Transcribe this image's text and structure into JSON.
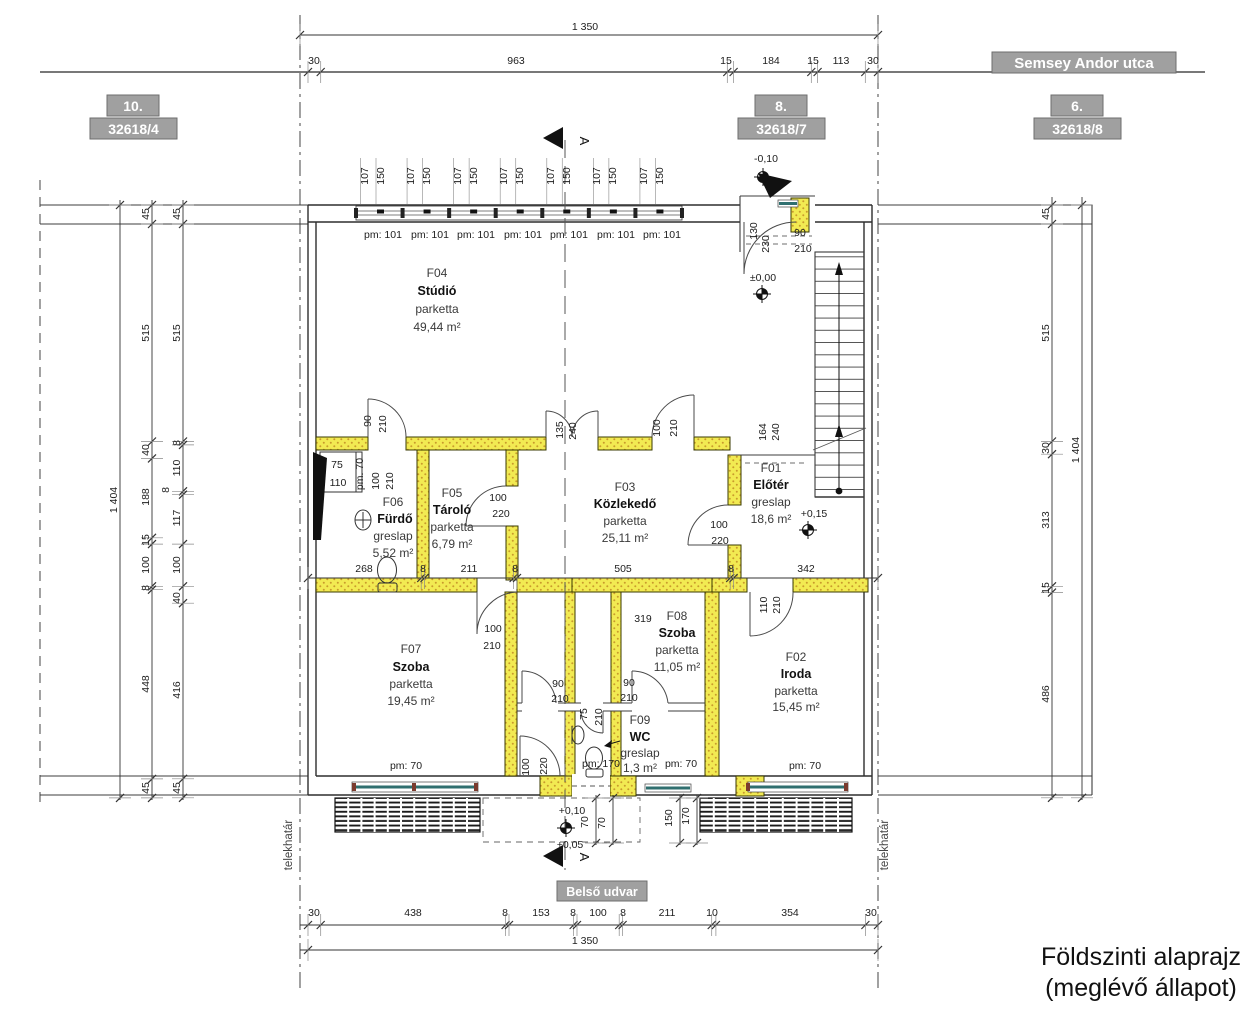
{
  "drawing_title": {
    "line1": "Földszinti alaprajz",
    "line2": "(meglévő állapot)"
  },
  "street": {
    "name": "Semsey Andor utca"
  },
  "courtyard": {
    "name": "Belső udvar"
  },
  "boundary": {
    "label_left": "telekhatár",
    "label_right": "telekhatár"
  },
  "section": {
    "letter": "A"
  },
  "parcels": [
    {
      "number": "10.",
      "lot": "32618/4"
    },
    {
      "number": "8.",
      "lot": "32618/7"
    },
    {
      "number": "6.",
      "lot": "32618/8"
    }
  ],
  "rooms": [
    {
      "id": "F04",
      "name": "Stúdió",
      "finish": "parketta",
      "area": "49,44 m²"
    },
    {
      "id": "F05",
      "name": "Tároló",
      "finish": "parketta",
      "area": "6,79 m²"
    },
    {
      "id": "F06",
      "name": "Fürdő",
      "finish": "greslap",
      "area": "5,52 m²"
    },
    {
      "id": "F03",
      "name": "Közlekedő",
      "finish": "parketta",
      "area": "25,11 m²"
    },
    {
      "id": "F01",
      "name": "Előtér",
      "finish": "greslap",
      "area": "18,6 m²"
    },
    {
      "id": "F07",
      "name": "Szoba",
      "finish": "parketta",
      "area": "19,45 m²"
    },
    {
      "id": "F08",
      "name": "Szoba",
      "finish": "parketta",
      "area": "11,05 m²"
    },
    {
      "id": "F09",
      "name": "WC",
      "finish": "greslap",
      "area": "1,3 m²"
    },
    {
      "id": "F02",
      "name": "Iroda",
      "finish": "parketta",
      "area": "15,45 m²"
    }
  ],
  "colors": {
    "wall_highlight": "#f2ea52",
    "glazing": "#2f6f6f",
    "annotation_box": "#a0a0a0"
  },
  "dimension_chains": [
    {
      "o": "h",
      "pos": 35,
      "from": 300,
      "to": 878,
      "ticks": [
        300,
        878
      ]
    },
    {
      "o": "h",
      "pos": 72,
      "from": 40,
      "to": 1205,
      "ticks": [
        308,
        320.7,
        727.3,
        733.6,
        811.3,
        817.6,
        865.3,
        878
      ]
    },
    {
      "o": "h",
      "pos": 578,
      "from": 308,
      "to": 878,
      "ticks": [
        308,
        421.2,
        424.5,
        513.6,
        517,
        730.2,
        733.6,
        878
      ]
    },
    {
      "o": "h",
      "pos": 925,
      "from": 300,
      "to": 878,
      "ticks": [
        308,
        320.7,
        505.6,
        509,
        573.6,
        577,
        619.2,
        622.6,
        711.7,
        715.9,
        865.4,
        878
      ]
    },
    {
      "o": "h",
      "pos": 950,
      "from": 300,
      "to": 878,
      "ticks": [
        308,
        878
      ]
    },
    {
      "o": "v",
      "pos": 152,
      "from": 200,
      "to": 800,
      "ticks": [
        205,
        224,
        441.5,
        458.4,
        537.8,
        544.1,
        586.3,
        589.7,
        778.9,
        797.9
      ]
    },
    {
      "o": "v",
      "pos": 183,
      "from": 200,
      "to": 800,
      "ticks": [
        205,
        224,
        441.5,
        444.9,
        491.3,
        494.7,
        544.1,
        586.3,
        603.2,
        778.8,
        797.8
      ]
    },
    {
      "o": "v",
      "pos": 120,
      "from": 200,
      "to": 800,
      "ticks": [
        205,
        797.9
      ]
    },
    {
      "o": "v",
      "pos": 1052,
      "from": 197,
      "to": 800,
      "ticks": [
        205,
        224,
        441.5,
        454.2,
        586.3,
        592.6,
        797.8
      ]
    },
    {
      "o": "v",
      "pos": 1082,
      "from": 197,
      "to": 800,
      "ticks": [
        205,
        797.8
      ]
    },
    {
      "o": "v",
      "pos": 596,
      "from": 795,
      "to": 845,
      "ticks": [
        798,
        843
      ]
    },
    {
      "o": "v",
      "pos": 613,
      "from": 795,
      "to": 845,
      "ticks": [
        798,
        843
      ]
    },
    {
      "o": "v",
      "pos": 680,
      "from": 795,
      "to": 845,
      "ticks": [
        798,
        843
      ]
    },
    {
      "o": "v",
      "pos": 697,
      "from": 795,
      "to": 845,
      "ticks": [
        798,
        843
      ]
    }
  ],
  "dimension_labels": [
    {
      "t": "1 350",
      "x": 585,
      "y": 30
    },
    {
      "t": "30",
      "x": 314,
      "y": 64
    },
    {
      "t": "963",
      "x": 516,
      "y": 64
    },
    {
      "t": "15",
      "x": 726,
      "y": 64
    },
    {
      "t": "184",
      "x": 771,
      "y": 64
    },
    {
      "t": "15",
      "x": 813,
      "y": 64
    },
    {
      "t": "113",
      "x": 841,
      "y": 64
    },
    {
      "t": "30",
      "x": 873,
      "y": 64
    },
    {
      "t": "107",
      "x": 368,
      "y": 176,
      "r": 1
    },
    {
      "t": "150",
      "x": 384,
      "y": 176,
      "r": 1
    },
    {
      "t": "107",
      "x": 414,
      "y": 176,
      "r": 1
    },
    {
      "t": "150",
      "x": 430,
      "y": 176,
      "r": 1
    },
    {
      "t": "107",
      "x": 461,
      "y": 176,
      "r": 1
    },
    {
      "t": "150",
      "x": 477,
      "y": 176,
      "r": 1
    },
    {
      "t": "107",
      "x": 507,
      "y": 176,
      "r": 1
    },
    {
      "t": "150",
      "x": 523,
      "y": 176,
      "r": 1
    },
    {
      "t": "107",
      "x": 554,
      "y": 176,
      "r": 1
    },
    {
      "t": "150",
      "x": 570,
      "y": 176,
      "r": 1
    },
    {
      "t": "107",
      "x": 600,
      "y": 176,
      "r": 1
    },
    {
      "t": "150",
      "x": 616,
      "y": 176,
      "r": 1
    },
    {
      "t": "107",
      "x": 647,
      "y": 176,
      "r": 1
    },
    {
      "t": "150",
      "x": 663,
      "y": 176,
      "r": 1
    },
    {
      "t": "pm: 101",
      "x": 383,
      "y": 238
    },
    {
      "t": "pm: 101",
      "x": 430,
      "y": 238
    },
    {
      "t": "pm: 101",
      "x": 476,
      "y": 238
    },
    {
      "t": "pm: 101",
      "x": 523,
      "y": 238
    },
    {
      "t": "pm: 101",
      "x": 569,
      "y": 238
    },
    {
      "t": "pm: 101",
      "x": 616,
      "y": 238
    },
    {
      "t": "pm: 101",
      "x": 662,
      "y": 238
    },
    {
      "t": "-0,10",
      "x": 766,
      "y": 162
    },
    {
      "t": "±0,00",
      "x": 763,
      "y": 281
    },
    {
      "t": "130",
      "x": 757,
      "y": 231,
      "r": 1
    },
    {
      "t": "230",
      "x": 769,
      "y": 244,
      "r": 1
    },
    {
      "t": "90",
      "x": 800,
      "y": 236
    },
    {
      "t": "210",
      "x": 803,
      "y": 252
    },
    {
      "t": "164",
      "x": 766,
      "y": 432,
      "r": 1
    },
    {
      "t": "240",
      "x": 779,
      "y": 432,
      "r": 1
    },
    {
      "t": "+0,15",
      "x": 814,
      "y": 517
    },
    {
      "t": "90",
      "x": 371,
      "y": 421,
      "r": 1
    },
    {
      "t": "210",
      "x": 386,
      "y": 424,
      "r": 1
    },
    {
      "t": "135",
      "x": 563,
      "y": 430,
      "r": 1
    },
    {
      "t": "240",
      "x": 576,
      "y": 431,
      "r": 1
    },
    {
      "t": "100",
      "x": 660,
      "y": 428,
      "r": 1
    },
    {
      "t": "210",
      "x": 677,
      "y": 428,
      "r": 1
    },
    {
      "t": "75",
      "x": 337,
      "y": 468
    },
    {
      "t": "110",
      "x": 338,
      "y": 486
    },
    {
      "t": "pm. 70",
      "x": 363,
      "y": 474,
      "r": 1
    },
    {
      "t": "100",
      "x": 379,
      "y": 481,
      "r": 1
    },
    {
      "t": "210",
      "x": 393,
      "y": 481,
      "r": 1
    },
    {
      "t": "100",
      "x": 498,
      "y": 501
    },
    {
      "t": "220",
      "x": 501,
      "y": 517
    },
    {
      "t": "100",
      "x": 719,
      "y": 528
    },
    {
      "t": "220",
      "x": 720,
      "y": 544
    },
    {
      "t": "268",
      "x": 364,
      "y": 572
    },
    {
      "t": "8",
      "x": 423,
      "y": 572
    },
    {
      "t": "211",
      "x": 469,
      "y": 572
    },
    {
      "t": "8",
      "x": 515,
      "y": 572
    },
    {
      "t": "505",
      "x": 623,
      "y": 572
    },
    {
      "t": "8",
      "x": 731,
      "y": 572
    },
    {
      "t": "342",
      "x": 806,
      "y": 572
    },
    {
      "t": "100",
      "x": 493,
      "y": 632
    },
    {
      "t": "210",
      "x": 492,
      "y": 649
    },
    {
      "t": "319",
      "x": 643,
      "y": 622
    },
    {
      "t": "90",
      "x": 558,
      "y": 687
    },
    {
      "t": "210",
      "x": 560,
      "y": 702
    },
    {
      "t": "90",
      "x": 629,
      "y": 686
    },
    {
      "t": "210",
      "x": 629,
      "y": 701
    },
    {
      "t": "75",
      "x": 587,
      "y": 714,
      "r": 1
    },
    {
      "t": "210",
      "x": 602,
      "y": 717,
      "r": 1
    },
    {
      "t": "110",
      "x": 767,
      "y": 605,
      "r": 1
    },
    {
      "t": "210",
      "x": 780,
      "y": 605,
      "r": 1
    },
    {
      "t": "100",
      "x": 529,
      "y": 767,
      "r": 1
    },
    {
      "t": "220",
      "x": 547,
      "y": 766,
      "r": 1
    },
    {
      "t": "pm: 70",
      "x": 406,
      "y": 769
    },
    {
      "t": "pm: 170",
      "x": 601,
      "y": 767
    },
    {
      "t": "pm: 70",
      "x": 681,
      "y": 767
    },
    {
      "t": "pm: 70",
      "x": 805,
      "y": 769
    },
    {
      "t": "+0,10",
      "x": 572,
      "y": 814
    },
    {
      "t": "70",
      "x": 588,
      "y": 822,
      "r": 1
    },
    {
      "t": "70",
      "x": 605,
      "y": 823,
      "r": 1
    },
    {
      "t": "150",
      "x": 672,
      "y": 818,
      "r": 1
    },
    {
      "t": "170",
      "x": 689,
      "y": 816,
      "r": 1
    },
    {
      "t": "+0,05",
      "x": 570,
      "y": 848
    },
    {
      "t": "45",
      "x": 149,
      "y": 214,
      "r": 1
    },
    {
      "t": "515",
      "x": 149,
      "y": 333,
      "r": 1
    },
    {
      "t": "40",
      "x": 149,
      "y": 450,
      "r": 1
    },
    {
      "t": "188",
      "x": 149,
      "y": 497,
      "r": 1
    },
    {
      "t": "15",
      "x": 149,
      "y": 540,
      "r": 1
    },
    {
      "t": "100",
      "x": 149,
      "y": 565,
      "r": 1
    },
    {
      "t": "8",
      "x": 149,
      "y": 588,
      "r": 1
    },
    {
      "t": "448",
      "x": 149,
      "y": 684,
      "r": 1
    },
    {
      "t": "45",
      "x": 149,
      "y": 788,
      "r": 1
    },
    {
      "t": "45",
      "x": 180,
      "y": 214,
      "r": 1
    },
    {
      "t": "515",
      "x": 180,
      "y": 333,
      "r": 1
    },
    {
      "t": "8",
      "x": 180,
      "y": 443,
      "r": 1
    },
    {
      "t": "110",
      "x": 180,
      "y": 468,
      "r": 1
    },
    {
      "t": "8",
      "x": 169,
      "y": 490,
      "r": 1
    },
    {
      "t": "117",
      "x": 180,
      "y": 518,
      "r": 1
    },
    {
      "t": "100",
      "x": 180,
      "y": 565,
      "r": 1
    },
    {
      "t": "40",
      "x": 180,
      "y": 598,
      "r": 1
    },
    {
      "t": "416",
      "x": 180,
      "y": 690,
      "r": 1
    },
    {
      "t": "45",
      "x": 180,
      "y": 788,
      "r": 1
    },
    {
      "t": "1 404",
      "x": 117,
      "y": 500,
      "r": 1
    },
    {
      "t": "45",
      "x": 1049,
      "y": 214,
      "r": 1
    },
    {
      "t": "515",
      "x": 1049,
      "y": 333,
      "r": 1
    },
    {
      "t": "30",
      "x": 1049,
      "y": 448,
      "r": 1
    },
    {
      "t": "313",
      "x": 1049,
      "y": 520,
      "r": 1
    },
    {
      "t": "15",
      "x": 1049,
      "y": 588,
      "r": 1
    },
    {
      "t": "486",
      "x": 1049,
      "y": 694,
      "r": 1
    },
    {
      "t": "1 404",
      "x": 1079,
      "y": 450,
      "r": 1
    },
    {
      "t": "30",
      "x": 314,
      "y": 916
    },
    {
      "t": "438",
      "x": 413,
      "y": 916
    },
    {
      "t": "8",
      "x": 505,
      "y": 916
    },
    {
      "t": "153",
      "x": 541,
      "y": 916
    },
    {
      "t": "8",
      "x": 573,
      "y": 916
    },
    {
      "t": "100",
      "x": 598,
      "y": 916
    },
    {
      "t": "8",
      "x": 623,
      "y": 916
    },
    {
      "t": "211",
      "x": 667,
      "y": 916
    },
    {
      "t": "10",
      "x": 712,
      "y": 916
    },
    {
      "t": "354",
      "x": 790,
      "y": 916
    },
    {
      "t": "30",
      "x": 871,
      "y": 916
    },
    {
      "t": "1 350",
      "x": 585,
      "y": 944
    }
  ]
}
